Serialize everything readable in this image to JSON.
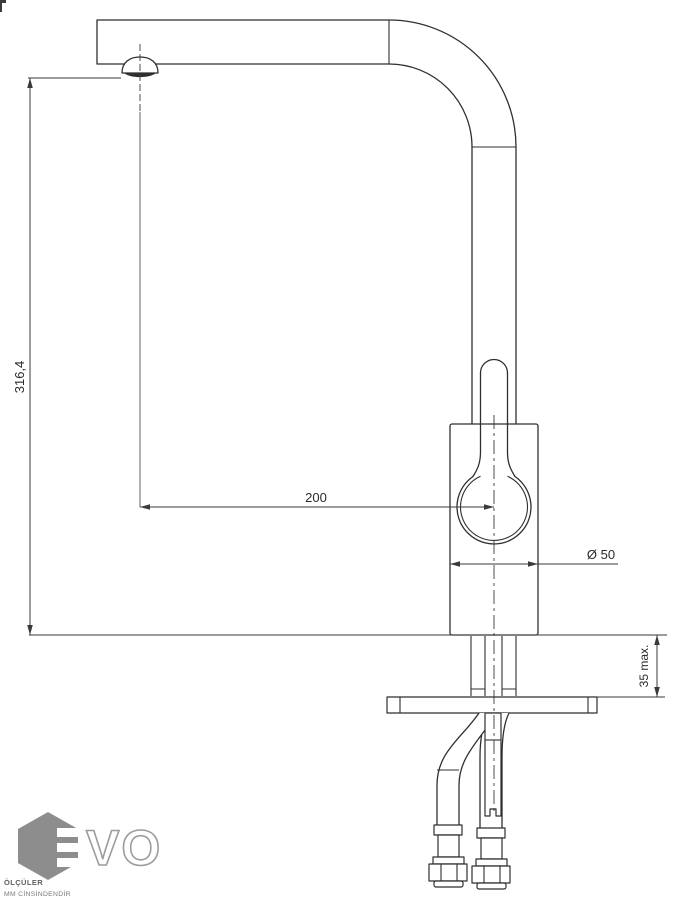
{
  "dimensions": {
    "height_label": "316,4",
    "reach_label": "200",
    "diameter_label": "Ø 50",
    "mount_label": "35 max."
  },
  "logo": {
    "letters": "VO"
  },
  "footer": {
    "line1": "ÖLÇÜLER",
    "line2": "MM CİNSİNDENDİR"
  },
  "colors": {
    "line": "#2f2f2f",
    "dim_line": "#3a3a3a",
    "text": "#2b2b2b",
    "logo_gray": "#8d8d8d",
    "logo_outline": "#9c9c9c",
    "footer_text": "#5f5f5f",
    "footer_text2": "#7a7a7a"
  }
}
